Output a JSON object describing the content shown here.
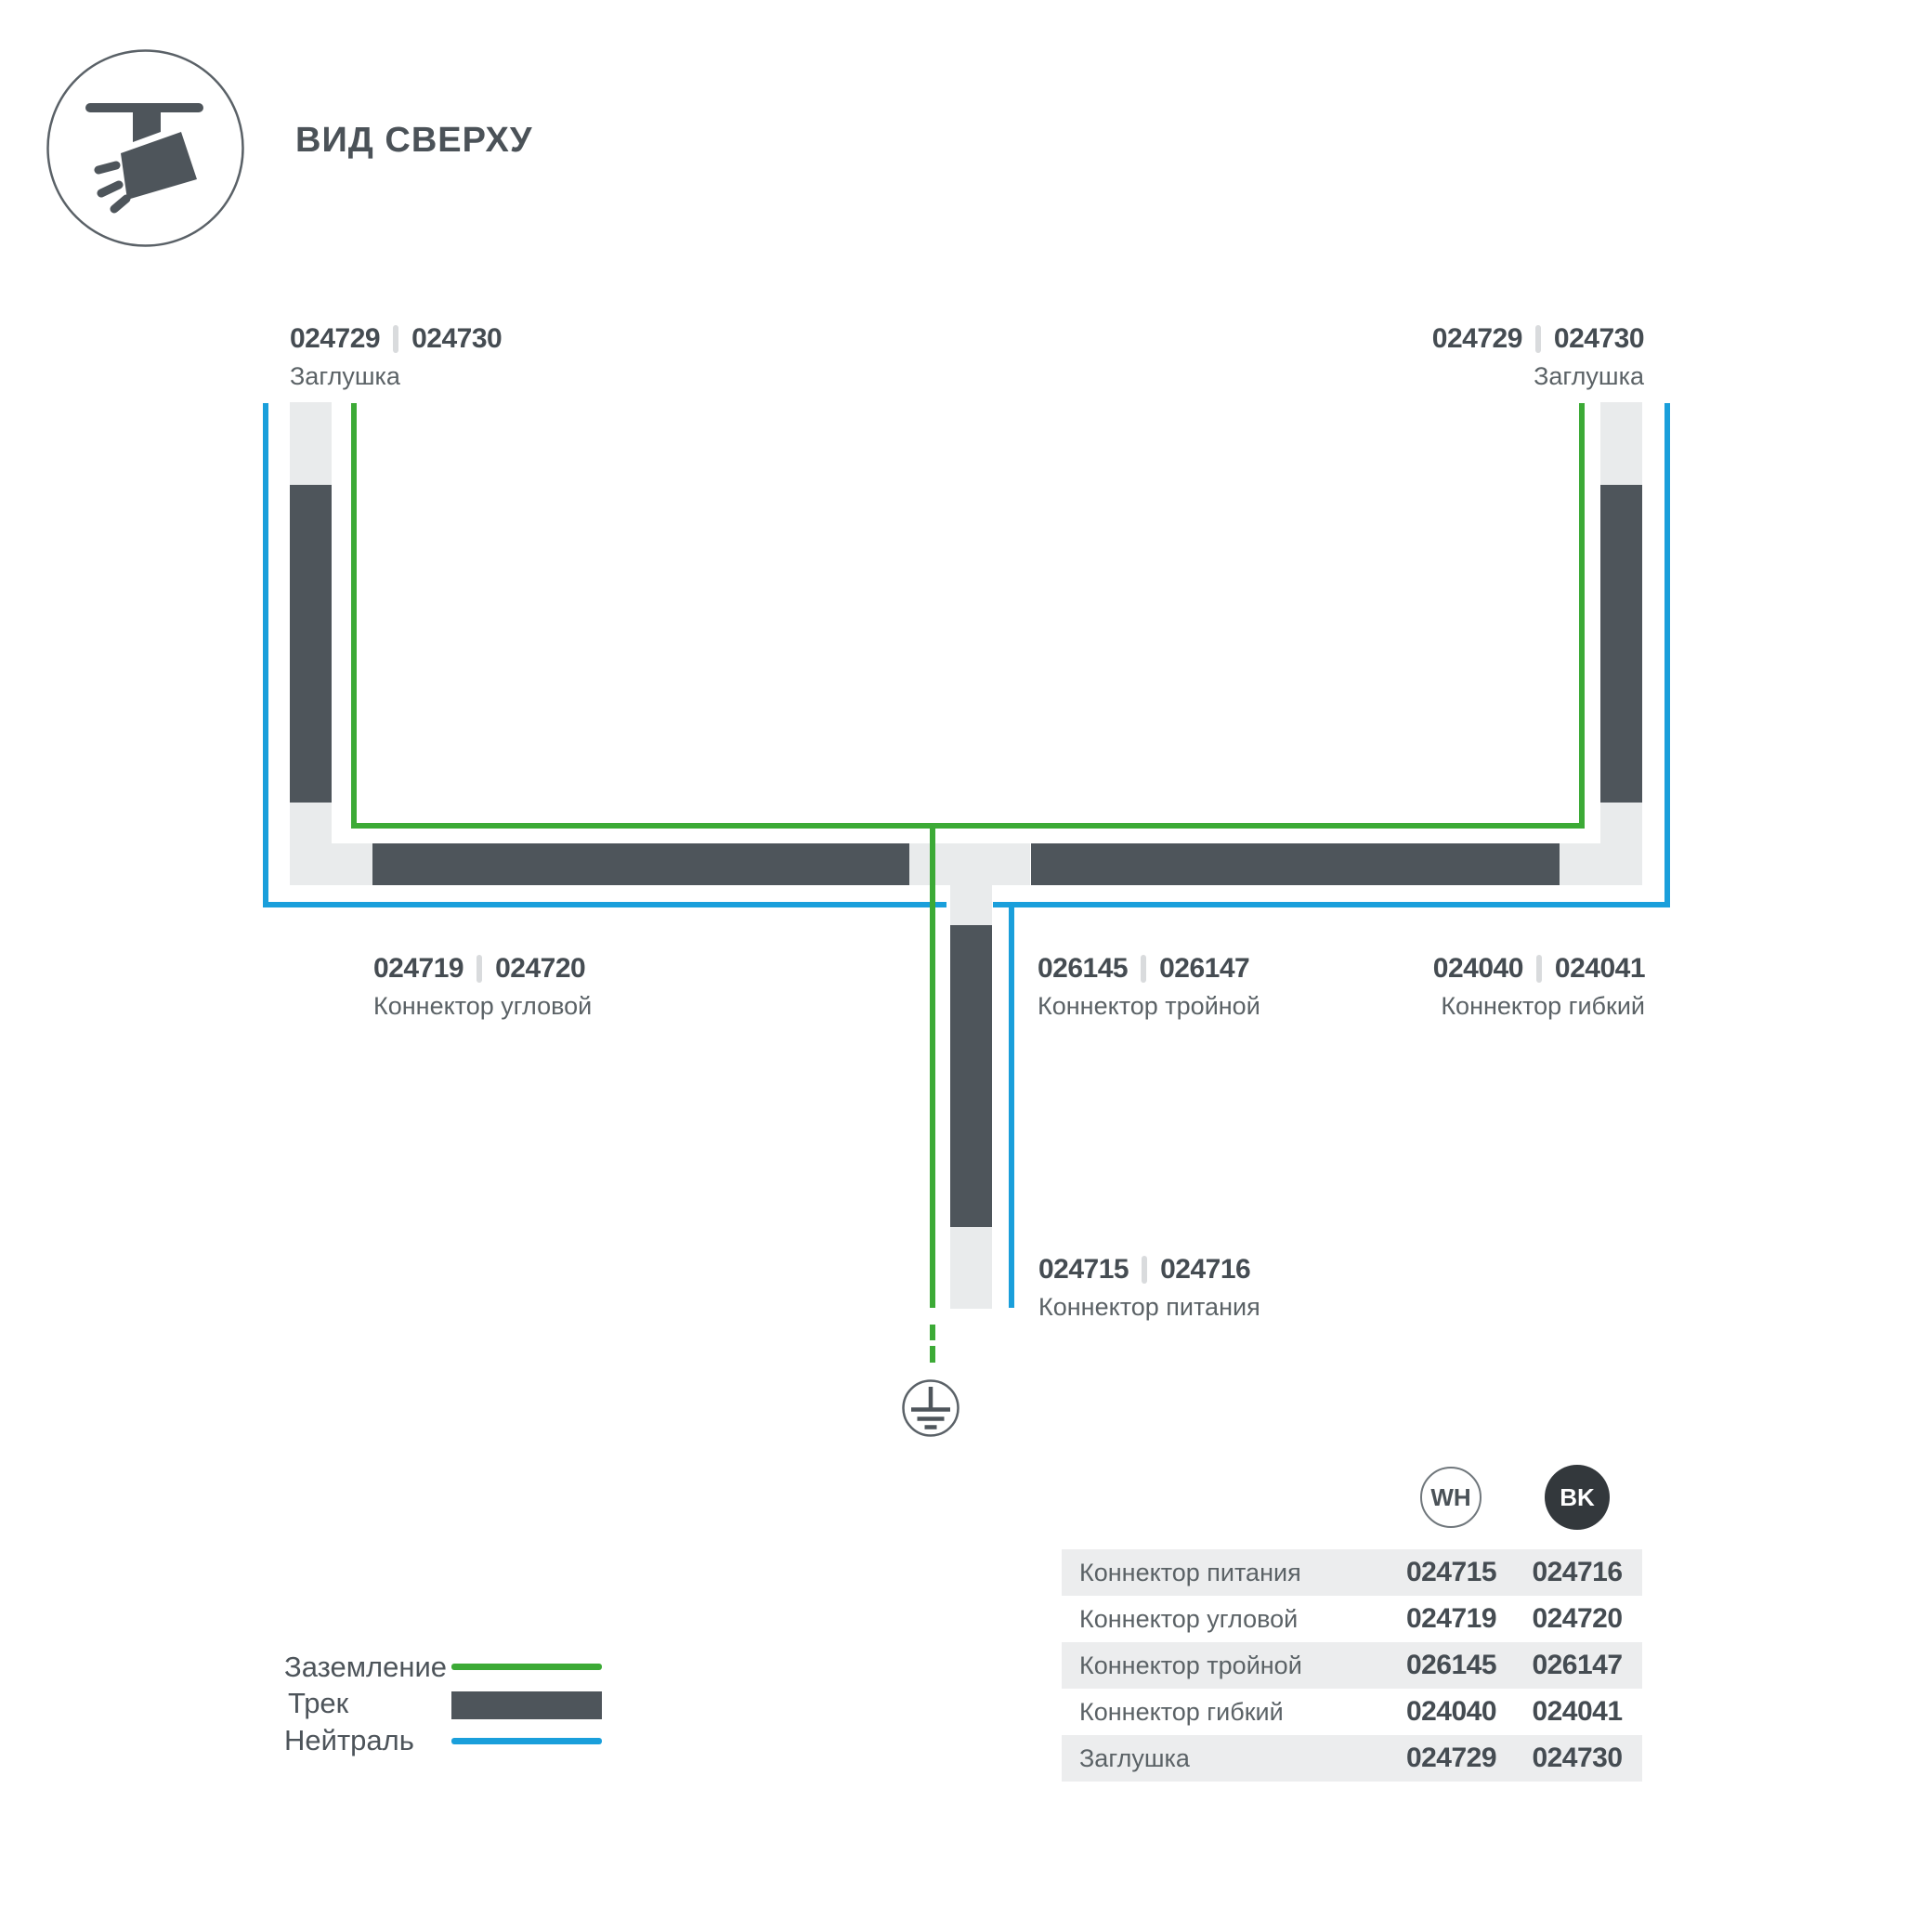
{
  "header": {
    "title": "ВИД СВЕРХУ"
  },
  "diagram": {
    "labels": {
      "cap_left": {
        "codes": [
          "024729",
          "024730"
        ],
        "name": "Заглушка"
      },
      "cap_right": {
        "codes": [
          "024729",
          "024730"
        ],
        "name": "Заглушка"
      },
      "corner": {
        "codes": [
          "024719",
          "024720"
        ],
        "name": "Коннектор угловой"
      },
      "triple": {
        "codes": [
          "026145",
          "026147"
        ],
        "name": "Коннектор тройной"
      },
      "flex": {
        "codes": [
          "024040",
          "024041"
        ],
        "name": "Коннектор гибкий"
      },
      "power": {
        "codes": [
          "024715",
          "024716"
        ],
        "name": "Коннектор питания"
      }
    },
    "colors": {
      "track": "#4e555b",
      "connector": "#e9ebec",
      "ground": "#3caa36",
      "neutral": "#1a9fdb"
    }
  },
  "legend": {
    "items": [
      {
        "label": "Заземление",
        "swatch": "ground-line",
        "color": "#3caa36"
      },
      {
        "label": "Трек",
        "swatch": "track-bar",
        "color": "#4e555b"
      },
      {
        "label": "Нейтраль",
        "swatch": "neutral-line",
        "color": "#1a9fdb"
      }
    ]
  },
  "table": {
    "columns": [
      "WH",
      "BK"
    ],
    "rows": [
      {
        "name": "Коннектор питания",
        "wh": "024715",
        "bk": "024716"
      },
      {
        "name": "Коннектор угловой",
        "wh": "024719",
        "bk": "024720"
      },
      {
        "name": "Коннектор тройной",
        "wh": "026145",
        "bk": "026147"
      },
      {
        "name": "Коннектор гибкий",
        "wh": "024040",
        "bk": "024041"
      },
      {
        "name": "Заглушка",
        "wh": "024729",
        "bk": "024730"
      }
    ]
  }
}
